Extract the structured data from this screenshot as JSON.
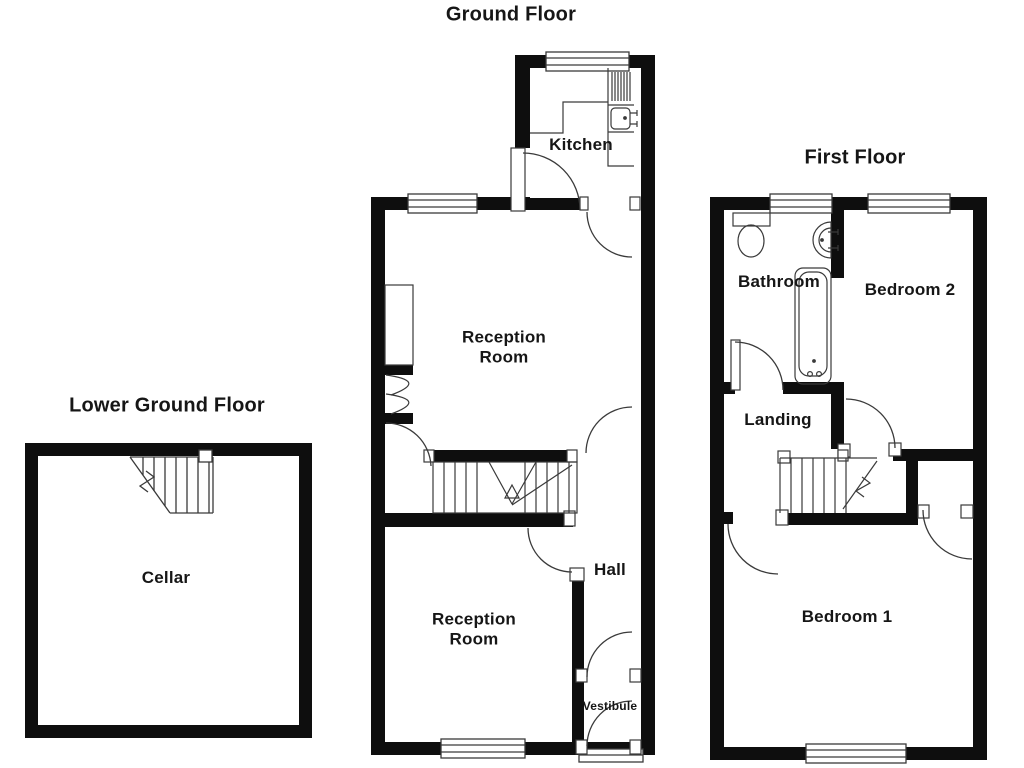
{
  "palette": {
    "background": "#ffffff",
    "wall_color": "#0e0e0e",
    "line_color": "#3a3a3a",
    "text_color": "#161616"
  },
  "floors": {
    "lower_ground": {
      "title": "Lower Ground Floor",
      "rooms": {
        "cellar": "Cellar"
      },
      "fixtures": [
        "staircase"
      ]
    },
    "ground": {
      "title": "Ground Floor",
      "rooms": {
        "kitchen": "Kitchen",
        "reception_1": "Reception\nRoom",
        "reception_2": "Reception\nRoom",
        "hall": "Hall",
        "vestibule": "Vestibule"
      },
      "fixtures": [
        "kitchen-sink",
        "draining-board",
        "worktop",
        "staircase",
        "fireplace",
        "windows",
        "front-door-threshold"
      ]
    },
    "first": {
      "title": "First Floor",
      "rooms": {
        "bathroom": "Bathroom",
        "bedroom_2": "Bedroom 2",
        "landing": "Landing",
        "bedroom_1": "Bedroom 1"
      },
      "fixtures": [
        "toilet",
        "wash-basin",
        "bathtub",
        "staircase",
        "cupboard",
        "windows"
      ]
    }
  }
}
